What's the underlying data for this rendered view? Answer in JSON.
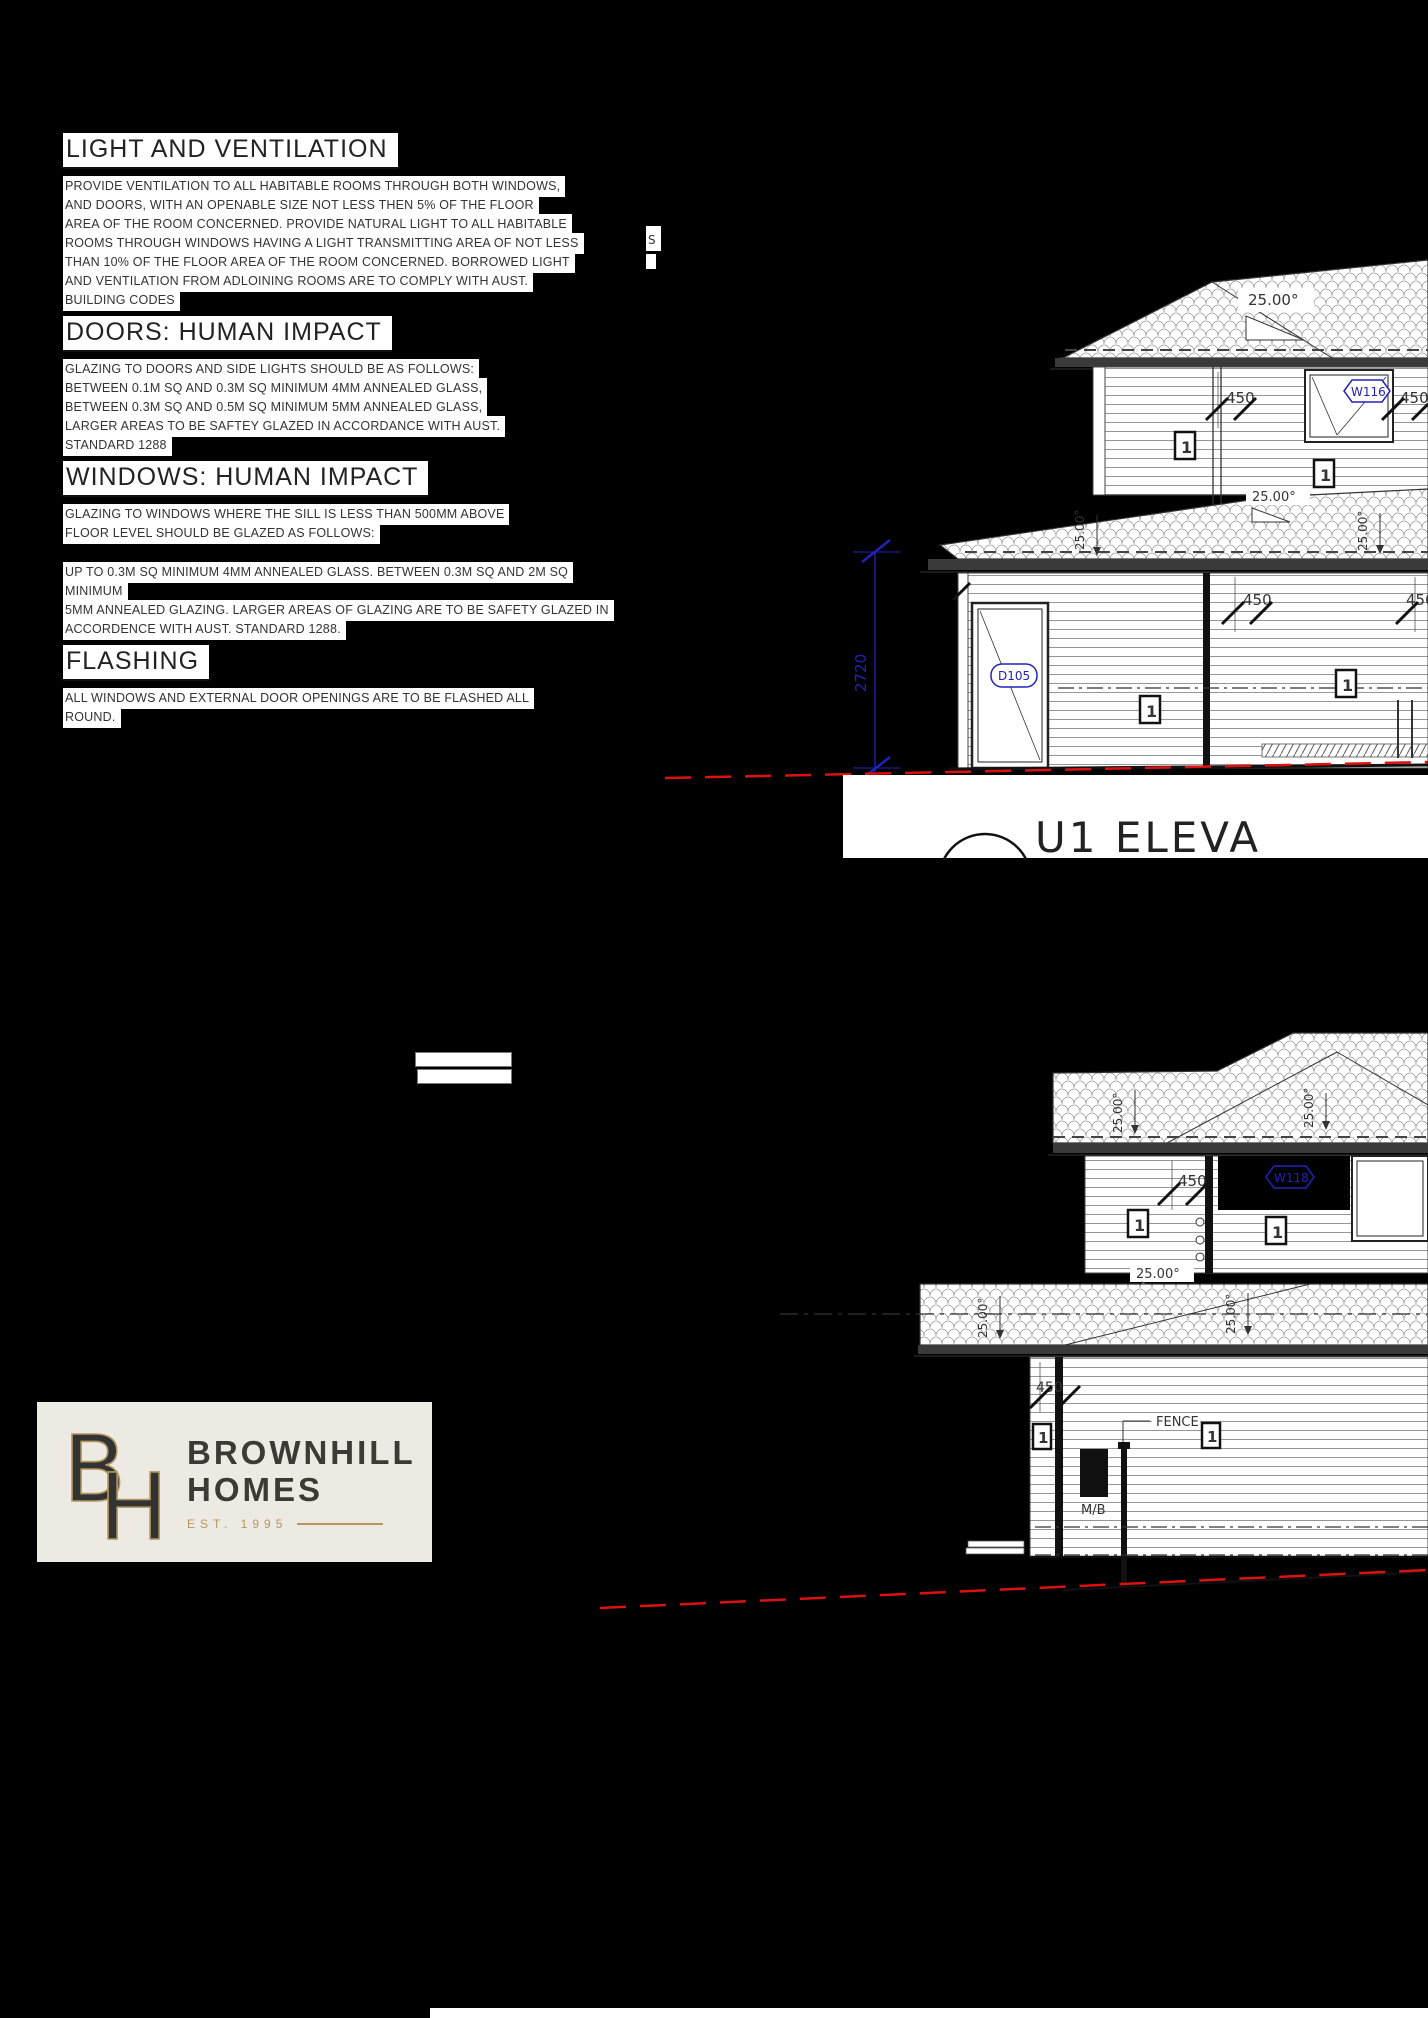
{
  "notes": {
    "sections": [
      {
        "title": "LIGHT AND VENTILATION",
        "lines": [
          "PROVIDE VENTILATION TO ALL HABITABLE ROOMS THROUGH BOTH WINDOWS,",
          "AND DOORS, WITH AN OPENABLE SIZE NOT LESS THEN 5% OF THE FLOOR",
          "AREA OF THE ROOM CONCERNED. PROVIDE NATURAL LIGHT TO ALL HABITABLE",
          "ROOMS THROUGH WINDOWS HAVING A LIGHT TRANSMITTING AREA OF NOT LESS",
          "THAN 10% OF THE FLOOR AREA OF THE ROOM CONCERNED. BORROWED LIGHT",
          "AND VENTILATION FROM ADLOINING ROOMS ARE TO COMPLY WITH AUST.",
          "BUILDING CODES"
        ]
      },
      {
        "title": "DOORS: HUMAN IMPACT",
        "lines": [
          "GLAZING TO DOORS AND SIDE LIGHTS  SHOULD BE AS FOLLOWS:",
          "BETWEEN 0.1M SQ AND 0.3M SQ MINIMUM 4MM ANNEALED GLASS,",
          "BETWEEN 0.3M SQ AND 0.5M SQ MINIMUM 5MM ANNEALED GLASS,",
          "LARGER AREAS TO BE SAFTEY GLAZED IN ACCORDANCE WITH AUST.",
          "STANDARD 1288"
        ]
      },
      {
        "title": "WINDOWS: HUMAN IMPACT",
        "lines": [
          "GLAZING TO WINDOWS WHERE THE SILL IS LESS THAN 500MM ABOVE",
          "FLOOR LEVEL SHOULD BE GLAZED AS FOLLOWS:",
          "UP TO 0.3M SQ MINIMUM 4MM ANNEALED GLASS. BETWEEN 0.3M SQ AND 2M SQ",
          "MINIMUM",
          "5MM ANNEALED GLAZING. LARGER AREAS OF GLAZING ARE TO BE SAFETY GLAZED IN",
          "ACCORDENCE WITH AUST. STANDARD 1288."
        ]
      },
      {
        "title": "FLASHING",
        "lines": [
          "ALL WINDOWS AND EXTERNAL DOOR OPENINGS ARE TO BE FLASHED ALL",
          "ROUND."
        ]
      }
    ]
  },
  "elevation1": {
    "title": "U1 ELEVA",
    "pitch": "25.00°",
    "dim_450": "450",
    "dim_2720": "2720",
    "window_tag": "W116",
    "door_tag": "D105",
    "marker": "1",
    "clipped_text": "S"
  },
  "elevation2": {
    "pitch": "25.00°",
    "dim_450": "450",
    "window_tag": "W118",
    "marker": "1",
    "fence_label": "FENCE",
    "meter_box_label": "M/B"
  },
  "logo": {
    "monogram_b": "B",
    "monogram_h": "H",
    "name_line1": "BROWNHILL",
    "name_line2": "HOMES",
    "est": "EST. 1995"
  },
  "colors": {
    "annotation_blue": "#2222bb",
    "ground_red": "#dd1111",
    "logo_gold": "#b3975f",
    "logo_text": "#3d3935",
    "logo_bg": "#edeae3"
  }
}
